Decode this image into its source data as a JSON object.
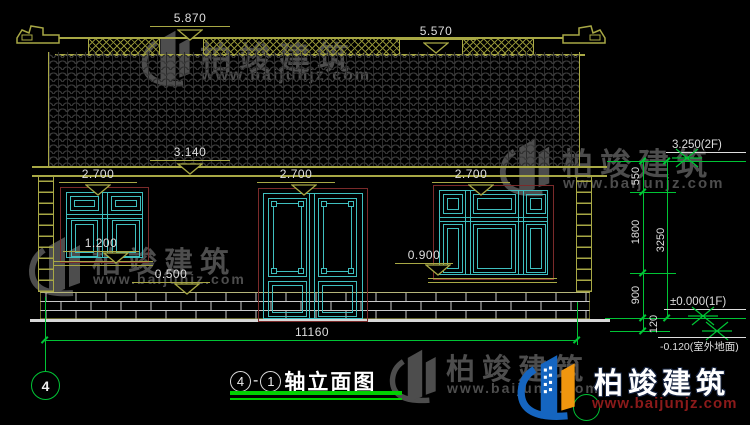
{
  "drawing": {
    "title": {
      "axis_a": "4",
      "dash": "-",
      "axis_b": "1",
      "name": "轴立面图"
    },
    "axis_bubble_left": "4"
  },
  "dims": {
    "ridge": "5.870",
    "ridge2": "5.570",
    "eave": "3.140",
    "open_left": "2.700",
    "open_mid": "2.700",
    "open_right": "2.700",
    "sill_left": "1.200",
    "plinth": "0.500",
    "sill_right": "0.900",
    "total_width": "11160",
    "v550": "550",
    "v1800": "1800",
    "v900": "900",
    "v120": "120",
    "v3250": "3250"
  },
  "levels": {
    "floor2": "3.250(2F)",
    "floor1": "±0.000(1F)",
    "ground": "-0.120(室外地面)"
  },
  "watermark": {
    "brand": "柏竣建筑",
    "url": "www.baijunjz.com"
  },
  "logo": {
    "brand": "柏竣建筑",
    "url": "www.baijunjz.com"
  },
  "colors": {
    "line_yellow": "#a8a845",
    "line_green": "#00c435",
    "line_teal": "#3fbfbf",
    "line_maroon": "#7a2a2a",
    "text_white": "#dedede",
    "watermark_gray": "#4d4d4d",
    "logo_blue": "#1565c0",
    "logo_orange": "#f0960f",
    "logo_url_red": "#8b1a1a"
  }
}
